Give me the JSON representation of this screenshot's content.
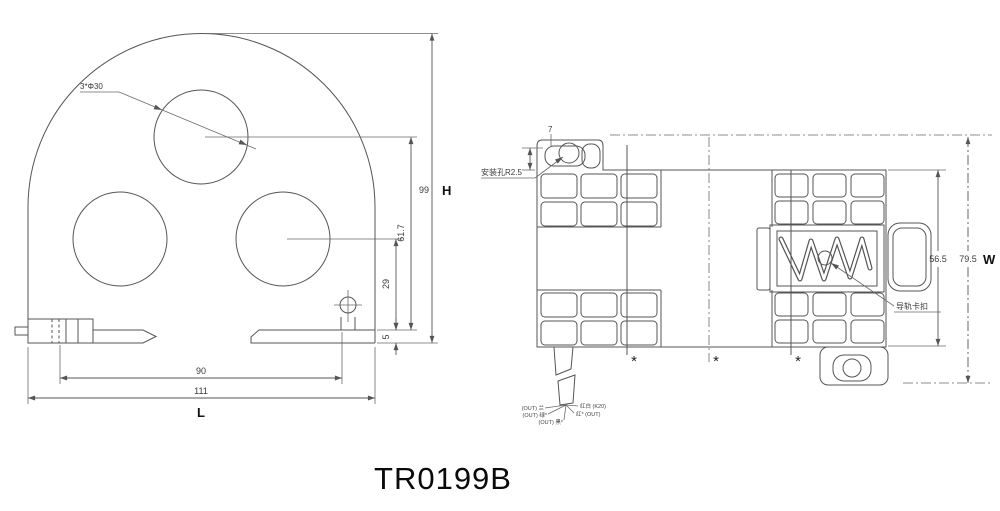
{
  "title": "TR0199B",
  "front_view": {
    "holes_label": "3*Φ30",
    "dim_height": "99",
    "dim_height_symbol": "H",
    "dim_hole_center": "61.7",
    "dim_lower_center": "29",
    "dim_foot": "5",
    "dim_mount_span": "90",
    "dim_overall_width": "111",
    "dim_width_symbol": "L"
  },
  "side_view": {
    "mount_hole_label": "安装孔R2.5",
    "rail_clip_label": "导轨卡扣",
    "dim_tab": "7",
    "dim_body_depth": "56.5",
    "dim_overall_depth": "79.5",
    "dim_depth_symbol": "W",
    "asterisk": "*",
    "wires": [
      "(OUT) 兰",
      "(OUT) 绿*",
      "(OUT) 黑*",
      "红白 (K20)",
      "红* (OUT)"
    ]
  },
  "colors": {
    "line": "#555555",
    "text": "#3a3a3a",
    "background": "#ffffff"
  }
}
